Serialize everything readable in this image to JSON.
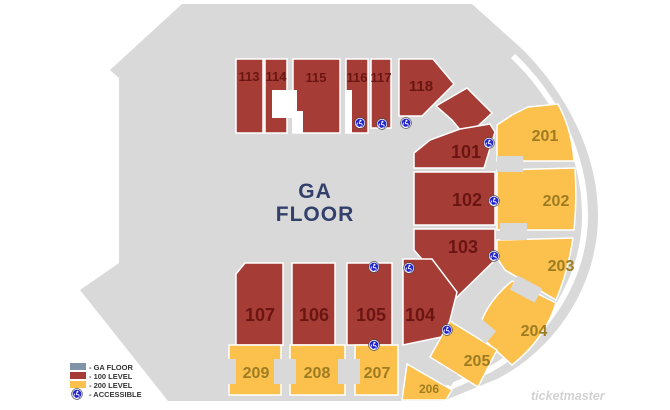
{
  "palette": {
    "background": "#ffffff",
    "venue_gray": "#d9d9d9",
    "level_100": "#a53c36",
    "level_100_label": "#6b1512",
    "level_200": "#fcc04d",
    "level_200_label": "#9d7c22",
    "ga_floor_label": "#32406b",
    "legend_ga_swatch": "#8093a8",
    "accessible_blue": "#2424cc",
    "legend_text": "#333333",
    "watermark_gray": "#d2d2d2"
  },
  "floor_label": {
    "line1": "GA",
    "line2": "FLOOR"
  },
  "sections": {
    "s101": {
      "label": "101"
    },
    "s102": {
      "label": "102"
    },
    "s103": {
      "label": "103"
    },
    "s104": {
      "label": "104"
    },
    "s105": {
      "label": "105"
    },
    "s106": {
      "label": "106"
    },
    "s107": {
      "label": "107"
    },
    "s113": {
      "label": "113"
    },
    "s114": {
      "label": "114"
    },
    "s115": {
      "label": "115"
    },
    "s116": {
      "label": "116"
    },
    "s117": {
      "label": "117"
    },
    "s118": {
      "label": "118"
    },
    "s201": {
      "label": "201"
    },
    "s202": {
      "label": "202"
    },
    "s203": {
      "label": "203"
    },
    "s204": {
      "label": "204"
    },
    "s205": {
      "label": "205"
    },
    "s206": {
      "label": "206"
    },
    "s207": {
      "label": "207"
    },
    "s208": {
      "label": "208"
    },
    "s209": {
      "label": "209"
    }
  },
  "legend": {
    "ga_floor": "- GA FLOOR",
    "level_100": "- 100 LEVEL",
    "level_200": "- 200 LEVEL",
    "accessible": "- ACCESSIBLE"
  },
  "watermark": "ticketmaster"
}
